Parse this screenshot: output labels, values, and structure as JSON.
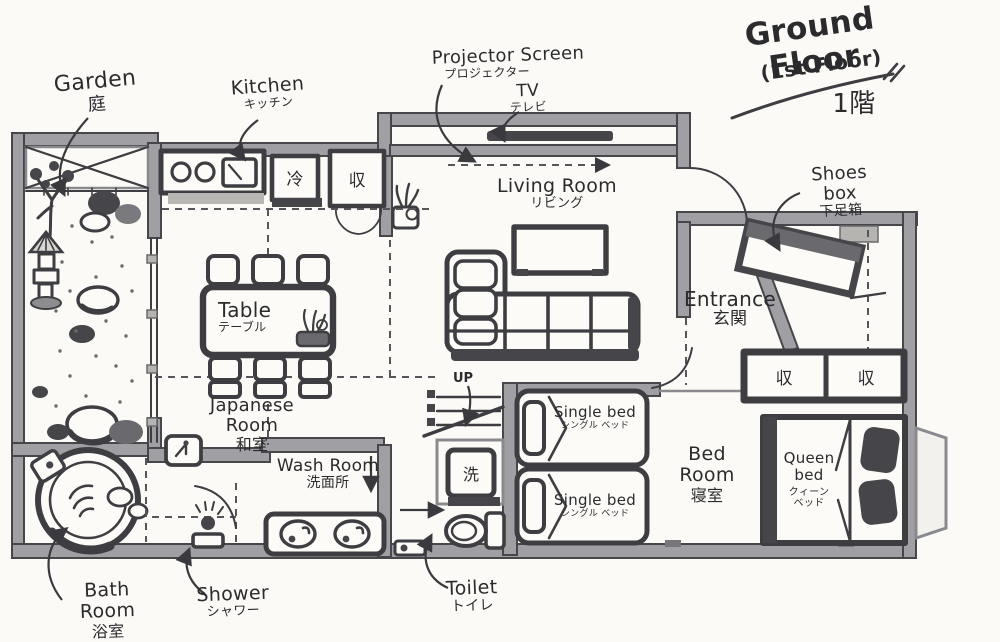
{
  "title": {
    "main": "Ground Floor",
    "sub": "(1st Floor)",
    "ja": "1階"
  },
  "callouts": {
    "garden": {
      "en": "Garden",
      "ja": "庭"
    },
    "kitchen": {
      "en": "Kitchen",
      "ja": "キッチン"
    },
    "projector_screen": {
      "en": "Projector Screen",
      "ja": "プロジェクター"
    },
    "tv": {
      "en": "TV",
      "ja": "テレビ"
    },
    "shoes_box": {
      "en": "Shoes box",
      "ja": "下足箱"
    },
    "bath_room": {
      "en": "Bath Room",
      "ja": "浴室"
    },
    "shower": {
      "en": "Shower",
      "ja": "シャワー"
    },
    "toilet": {
      "en": "Toilet",
      "ja": "トイレ"
    }
  },
  "rooms": {
    "living_room": {
      "en": "Living Room",
      "ja": "リビング"
    },
    "entrance": {
      "en": "Entrance",
      "ja": "玄関"
    },
    "japanese_room": {
      "en": "Japanese Room",
      "ja": "和室"
    },
    "wash_room": {
      "en": "Wash Room",
      "ja": "洗面所"
    },
    "bed_room": {
      "en": "Bed Room",
      "ja": "寝室"
    }
  },
  "furniture": {
    "table": {
      "en": "Table",
      "ja": "テーブル"
    },
    "single_bed_top": {
      "en": "Single bed",
      "ja": "シングル ベッド"
    },
    "single_bed_bottom": {
      "en": "Single bed",
      "ja": "シングル ベッド"
    },
    "queen_bed": {
      "en_line1": "Queen",
      "en_line2": "bed",
      "ja_line1": "クィーン",
      "ja_line2": "ベッド"
    }
  },
  "fixtures": {
    "fridge": "冷",
    "kitchen_storage": "収",
    "closet_left": "収",
    "closet_right": "収",
    "washing_machine": "洗",
    "stairs": "UP"
  },
  "colors": {
    "ink": "#3a3a3e",
    "wall_gray": "#a0a0a4",
    "paper": "#fbfaf7"
  }
}
